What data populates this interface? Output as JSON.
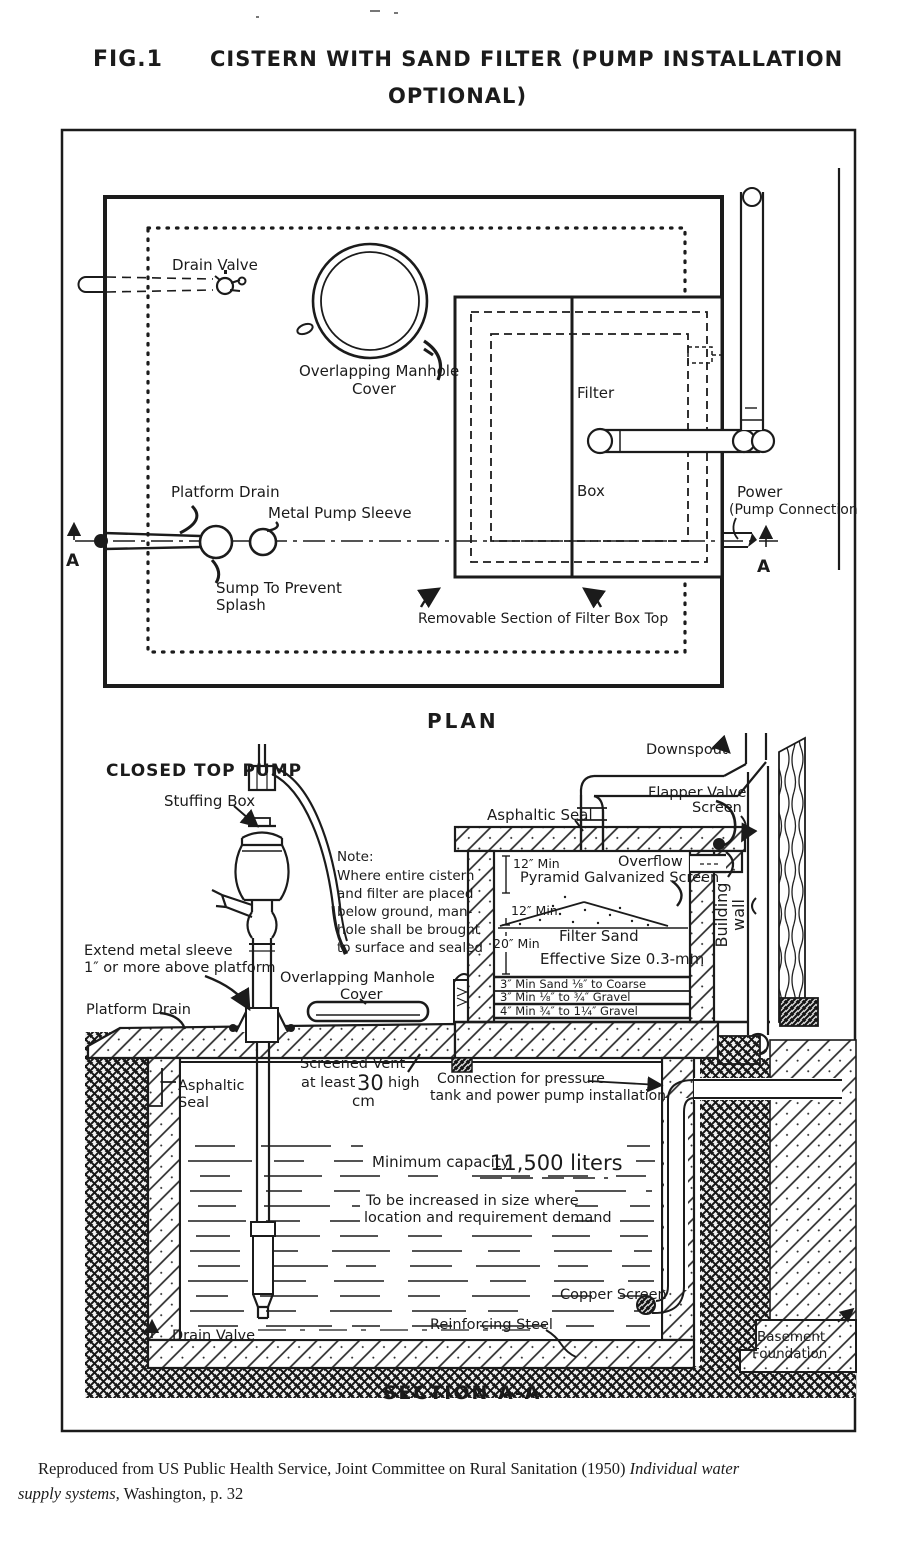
{
  "figure": {
    "label": "FIG.1",
    "title_line1": "CISTERN WITH SAND FILTER (PUMP INSTALLATION",
    "title_line2": "OPTIONAL)"
  },
  "plan": {
    "caption": "PLAN",
    "drain_valve": "Drain Valve",
    "manhole_line1": "Overlapping Manhole",
    "manhole_line2": "Cover",
    "filter": "Filter",
    "box": "Box",
    "platform_drain": "Platform Drain",
    "metal_pump_sleeve": "Metal Pump Sleeve",
    "sump_line1": "Sump To Prevent",
    "sump_line2": "Splash",
    "power_line1": "Power",
    "power_line2": "(Pump Connection",
    "removable_section": "Removable Section of Filter Box Top",
    "marker_left": "A",
    "marker_right": "A"
  },
  "section": {
    "caption": "SECTION A-A",
    "closed_top_pump": "CLOSED TOP PUMP",
    "stuffing_box": "Stuffing Box",
    "note": {
      "l1": "Note:",
      "l2": "Where entire cistern",
      "l3": "and filter are placed",
      "l4": "below ground, man-",
      "l5": "hole shall be brought",
      "l6": "to surface and sealed"
    },
    "asphaltic_seal_top": "Asphaltic Seal",
    "downspout": "Downspout",
    "flapper_line1": "Flapper Valve",
    "flapper_line2": "Screen",
    "overflow": "Overflow",
    "dim_12_upper": "12″ Min",
    "pyramid_screen": "Pyramid Galvanized Screen",
    "dim_12_lower": "12″ Min",
    "dim_20": "20″ Min",
    "filter_sand": "Filter Sand",
    "effective_size": "Effective Size 0.3-mm",
    "layer1": "3″ Min    Sand ⅛″ to Coarse",
    "layer2": "3″ Min    ⅛″ to ¾″ Gravel",
    "layer3": "4″ Min    ¾″ to 1¼″ Gravel",
    "building_line1": "Building",
    "building_line2": "wall",
    "extend_line1": "Extend metal sleeve",
    "extend_line2": "1″ or more above platform",
    "manhole_line1": "Overlapping Manhole",
    "manhole_line2": "Cover",
    "platform_drain": "Platform Drain",
    "asphaltic_line1": "Asphaltic",
    "asphaltic_line2": "Seal",
    "vent_line1": "Screened Vent",
    "vent_at_least": "at least",
    "vent_value": "30",
    "vent_high": "high",
    "vent_unit": "cm",
    "conn_line1": "Connection for pressure",
    "conn_line2": "tank and power pump installation",
    "capacity_label": "Minimum capacity",
    "capacity_value": "11,500 liters",
    "increase_line1": "To be increased in size where",
    "increase_line2": "location and requirement demand",
    "copper_screen": "Copper Screen",
    "drain_valve": "Drain Valve",
    "reinforcing_steel": "Reinforcing Steel",
    "basement_line1": "Basement",
    "basement_line2": "Foundation"
  },
  "citation": {
    "line1_normal": "Reproduced from US Public Health Service, Joint Committee on Rural Sanitation (1950) ",
    "line1_italic": "Individual water",
    "line2_italic": "supply systems,",
    "line2_normal": " Washington, p. 32"
  },
  "colors": {
    "ink": "#1b1b1b",
    "paper": "#ffffff"
  }
}
